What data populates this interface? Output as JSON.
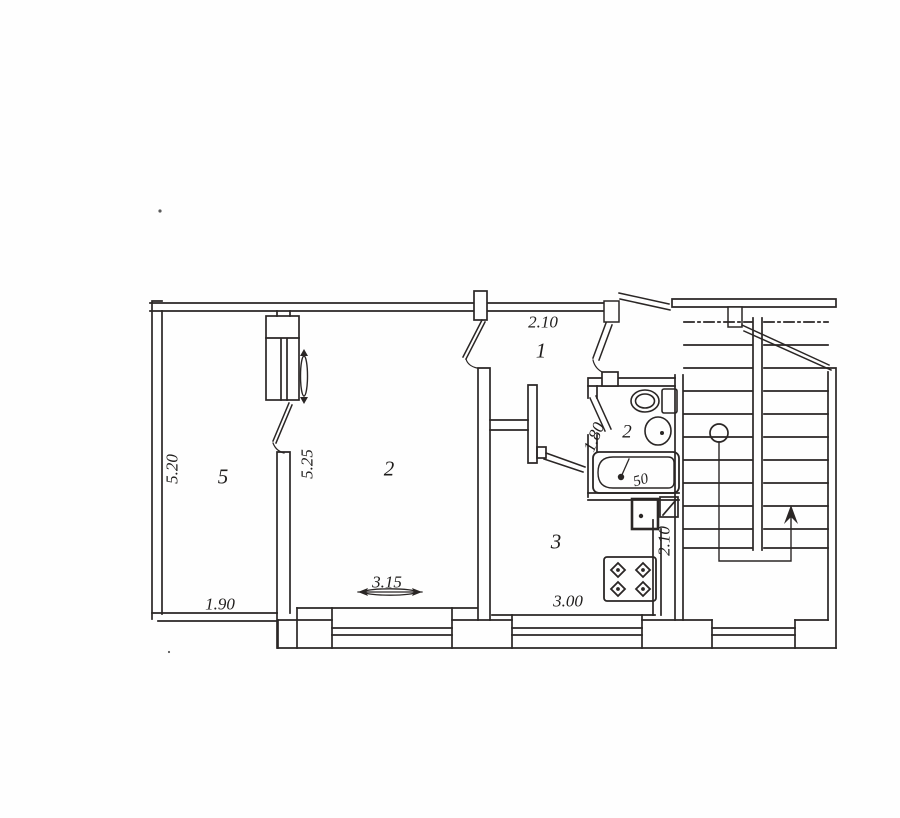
{
  "document": {
    "type": "apartment floor plan (scanned drawing)",
    "colors": {
      "ink": "#2a2a2a",
      "paper": "#ffffff"
    }
  },
  "labels": {
    "room_5_number": "5",
    "room_5_height": "5.20",
    "room_5_width": "1.90",
    "room_2_number": "2",
    "room_2_height": "5.25",
    "room_2_width": "3.15",
    "hall_number": "1",
    "hall_width": "2.10",
    "bathroom_number": "2",
    "bathroom_width": "1.80",
    "bathtub_size": "50",
    "kitchen_number": "3",
    "kitchen_width": "3.00",
    "kitchen_depth": "2.10"
  },
  "symbols": [
    "staircase-with-up-arrow",
    "stair-column-circle",
    "bathtub-with-drain",
    "toilet",
    "washbasin",
    "gas-stove-4-burners",
    "ventilation-shaft",
    "water-heater-box",
    "built-in-closet",
    "window-vent-arrow",
    "door-swing-leaves"
  ]
}
